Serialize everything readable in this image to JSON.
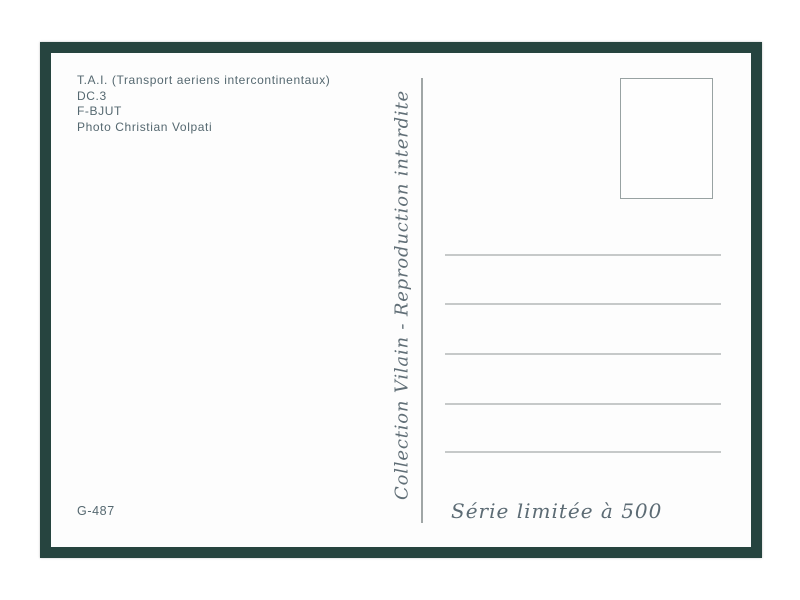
{
  "card": {
    "info_lines": [
      "T.A.I. (Transport aeriens intercontinentaux)",
      "DC.3",
      "F-BJUT",
      "Photo Christian Volpati"
    ],
    "collection_text": "Collection Vilain - Reproduction interdite",
    "series_text": "Série limitée à 500",
    "reference_number": "G-487",
    "address_lines": {
      "count": 5
    },
    "stamp_box": {
      "label": ""
    },
    "colors": {
      "frame": "#26443f",
      "info_text": "#556870",
      "script_text": "#5c6b74",
      "divider": "#a0a6a6",
      "address_line": "#c6c9c9",
      "stamp_border": "#98a2a2"
    }
  }
}
